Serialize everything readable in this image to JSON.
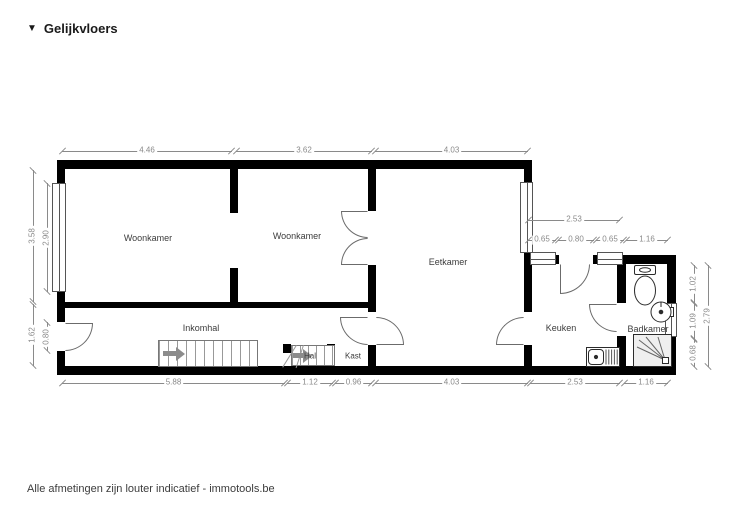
{
  "header": {
    "collapse_icon": "▼",
    "title": "Gelijkvloers"
  },
  "footer": {
    "disclaimer": "Alle afmetingen zijn louter indicatief - immotools.be"
  },
  "rooms": {
    "woonkamer1": "Woonkamer",
    "woonkamer2": "Woonkamer",
    "eetkamer": "Eetkamer",
    "inkomhal": "Inkomhal",
    "hal": "Hal",
    "kast": "Kast",
    "keuken": "Keuken",
    "badkamer": "Badkamer"
  },
  "fixtures": [
    "toilet",
    "washbasin",
    "shower",
    "kitchen-sink",
    "staircase-up",
    "staircase-down"
  ],
  "dimensions": {
    "top": [
      "4.46",
      "3.62",
      "4.03"
    ],
    "bottom": [
      "5.88",
      "1.12",
      "0.96",
      "4.03",
      "2.53",
      "1.16"
    ],
    "left_outer": [
      "3.58",
      "1.62"
    ],
    "left_inner": [
      "2.90",
      "0.80"
    ],
    "annex_top": [
      "2.53",
      "0.65",
      "0.80",
      "0.65",
      "1.16"
    ],
    "right_inner": [
      "1.02",
      "1.09",
      "0.68"
    ],
    "right_outer": [
      "2.79"
    ]
  },
  "colors": {
    "wall": "#000000",
    "line": "#6b6b6b",
    "dim": "#8a8a8a",
    "label": "#3c3c3c"
  }
}
